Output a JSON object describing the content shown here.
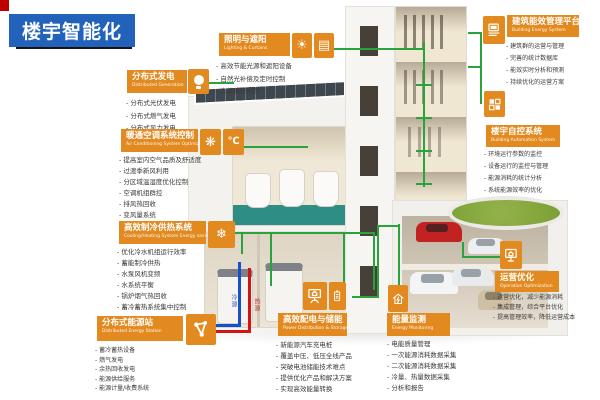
{
  "title": "楼宇智能化",
  "colors": {
    "accent_orange": "#e2891f",
    "title_blue": "#2262bb",
    "line_green": "#2aa33c",
    "pipe_cold_blue": "#1750c8",
    "pipe_hot_red": "#d41414",
    "corner_red": "#c00000",
    "lawn_green": "#85a83f"
  },
  "pipes": {
    "cold": "冷源",
    "hot": "热源"
  },
  "sections": {
    "generation": {
      "title_zh": "分布式发电",
      "title_en": "Distributed Generation",
      "items": [
        "分布式光伏发电",
        "分布式燃气发电",
        "分布式风力发电"
      ]
    },
    "lighting": {
      "title_zh": "照明与遮阳",
      "title_en": "Lighting & Curtains",
      "glyphs": [
        "☀",
        "▤"
      ],
      "items": [
        "高效节能光源和遮阳设备",
        "自然光补偿及定时控制",
        "人体感应控制"
      ]
    },
    "hvac": {
      "title_zh": "暖通空调系统控制",
      "title_en": "Air Conditioning System Optimized Control",
      "glyphs": [
        "❋",
        "℃"
      ],
      "items": [
        "提高室内空气品质及舒适度",
        "过渡季新风利用",
        "分区域温湿度优化控制",
        "空调机组群控",
        "排风热回收",
        "变风量系统"
      ]
    },
    "cooling": {
      "title_zh": "高效制冷供热系统",
      "title_en": "Cooling/Heating System Energy saving",
      "glyph": "❄",
      "items": [
        "优化冷水机组运行效率",
        "蓄能制冷供热",
        "水泵风机变频",
        "水系统平衡",
        "锅炉烟气热回收",
        "蓄冷蓄热系统集中控制"
      ]
    },
    "station": {
      "title_zh": "分布式能源站",
      "title_en": "Distributed Energy Station",
      "items": [
        "蓄冷蓄热设备",
        "燃气发电",
        "余热回收发电",
        "能源供给服务",
        "能源计量/收费系统"
      ]
    },
    "power": {
      "title_zh": "高效配电与储能",
      "title_en": "Power Distribution & Storage",
      "items": [
        "新能源汽车充电桩",
        "覆盖中压、低压全线产品",
        "突破电池储能技术难点",
        "提供优化产品和解决方案",
        "实现高效能量转换"
      ]
    },
    "monitoring": {
      "title_zh": "能量监测",
      "title_en": "Energy Monitoring",
      "items": [
        "电能质量管理",
        "一次能源消耗数据采集",
        "二次能源消耗数据采集",
        "冷量、热量数据采集",
        "分析和报告"
      ]
    },
    "optimization": {
      "title_zh": "运营优化",
      "title_en": "Operation Optimization",
      "items": [
        "运营优化，减少能源消耗",
        "集成管理，综合平台优化",
        "提高管理效率，降低运营成本"
      ]
    },
    "platform": {
      "title_zh": "建筑能效管理平台",
      "title_en": "Building Energy System",
      "items": [
        "建筑群的运营与管理",
        "完善的统计数据库",
        "能效实时分析和预测",
        "持续优化的运营方案"
      ]
    },
    "automation": {
      "title_zh": "楼宇自控系统",
      "title_en": "Building Automation System",
      "items": [
        "环境运行参数的监控",
        "设备运行的监控与管理",
        "能源消耗的统计分析",
        "系统能源效率的优化"
      ]
    }
  }
}
